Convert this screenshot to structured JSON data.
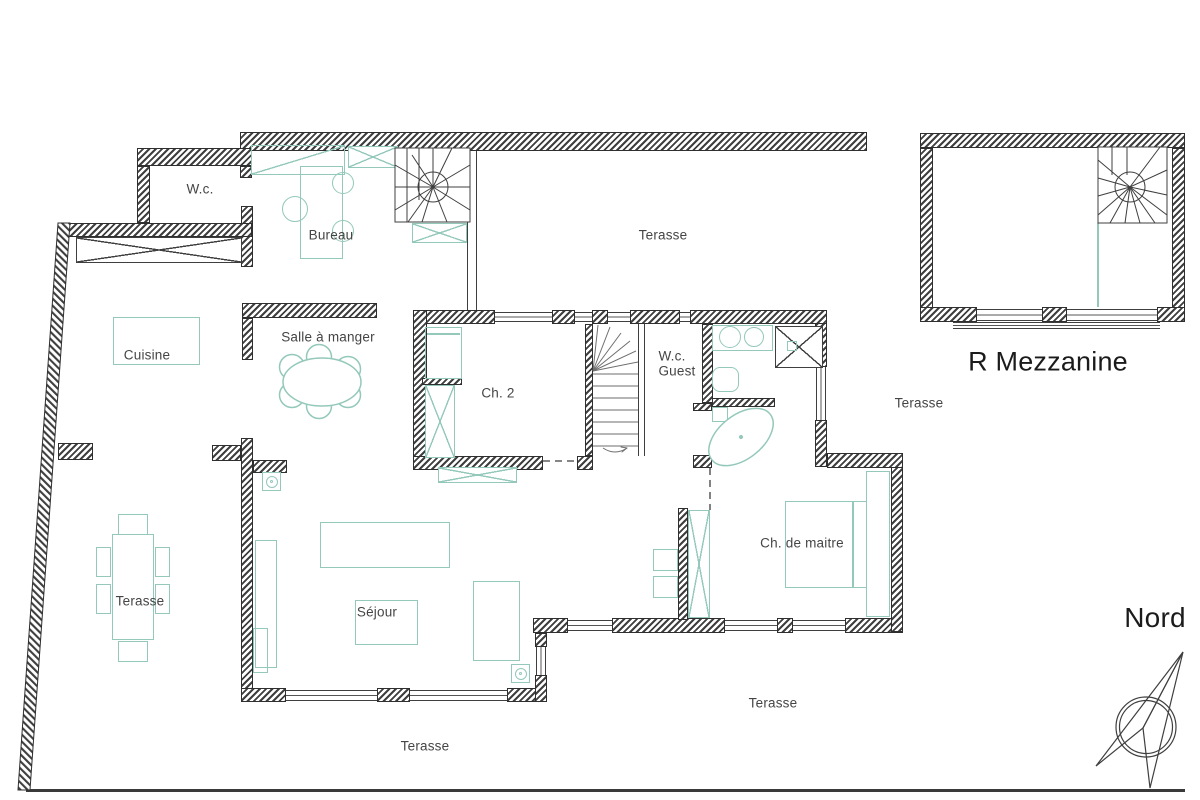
{
  "drawing_type": "architectural floor plan",
  "labels": {
    "wc": "W.c.",
    "bureau": "Bureau",
    "terasse_top": "Terasse",
    "cuisine": "Cuisine",
    "salle_a_manger": "Salle à manger",
    "ch2": "Ch. 2",
    "wc_guest_l1": "W.c.",
    "wc_guest_l2": "Guest",
    "terasse_right": "Terasse",
    "ch_de_maitre": "Ch. de maitre",
    "sejour": "Séjour",
    "terasse_left": "Terasse",
    "terasse_bottom_left": "Terasse",
    "terasse_bottom_right": "Terasse",
    "r_mezzanine": "R Mezzanine",
    "nord": "Nord"
  },
  "colors": {
    "wall_hatch": "#3f3f3f",
    "furniture_teal": "#93c8ba",
    "label_text": "#454545",
    "title_text": "#1b1b1b",
    "background": "#ffffff"
  }
}
